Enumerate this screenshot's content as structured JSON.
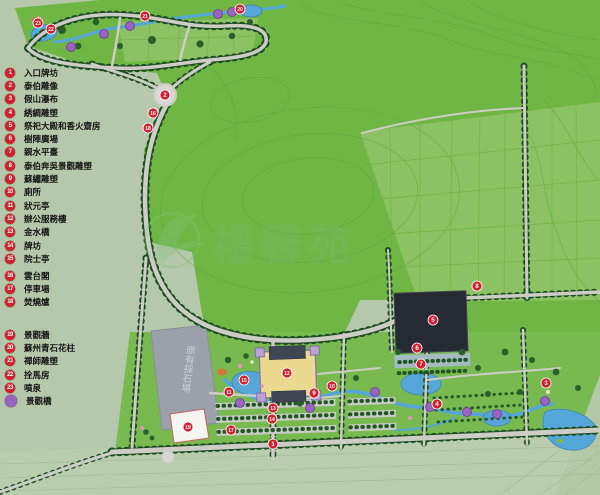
{
  "legend": {
    "groups": [
      {
        "items": [
          {
            "num": "1",
            "label": "入口牌坊"
          },
          {
            "num": "2",
            "label": "泰伯雕像"
          },
          {
            "num": "3",
            "label": "假山瀑布"
          },
          {
            "num": "4",
            "label": "綉綢雕塑"
          },
          {
            "num": "5",
            "label": "祭祀大殿和香火齋房"
          },
          {
            "num": "6",
            "label": "樹陣廣場"
          },
          {
            "num": "7",
            "label": "親水平臺"
          },
          {
            "num": "8",
            "label": "泰伯奔吳景觀雕塑"
          },
          {
            "num": "9",
            "label": "蘇繡雕塑"
          },
          {
            "num": "10",
            "label": "廁所"
          },
          {
            "num": "11",
            "label": "狀元亭"
          },
          {
            "num": "12",
            "label": "辦公服務樓"
          },
          {
            "num": "13",
            "label": "金水橋"
          },
          {
            "num": "14",
            "label": "牌坊"
          },
          {
            "num": "15",
            "label": "院士亭"
          }
        ]
      },
      {
        "items": [
          {
            "num": "16",
            "label": "雲台閣"
          },
          {
            "num": "17",
            "label": "停車場"
          },
          {
            "num": "18",
            "label": "焚燒爐"
          }
        ]
      },
      {
        "items": [
          {
            "num": "19",
            "label": "景觀牆"
          },
          {
            "num": "20",
            "label": "蘇州青石花柱"
          },
          {
            "num": "21",
            "label": "禪師雕塑"
          },
          {
            "num": "22",
            "label": "拴馬房"
          },
          {
            "num": "23",
            "label": "噴泉"
          }
        ]
      },
      {
        "items": [
          {
            "num": "",
            "label": "景觀橋",
            "type": "bridge"
          }
        ]
      }
    ]
  },
  "map": {
    "quarry_label": "原有採石場",
    "watermark_text": "楊馨苑",
    "colors": {
      "marker_red": "#d1202f",
      "bridge_purple": "#9b63c0",
      "water": "#55a7da",
      "hill_green": "#6fb645",
      "sage": "#b6c8ab",
      "road_grey": "#cdcdc6",
      "building_dark": "#262b33",
      "quarry_grey": "#9aa1ab",
      "courtyard_yellow": "#ead98f"
    },
    "markers": [
      {
        "n": "1",
        "x": 273,
        "y": 444
      },
      {
        "n": "2",
        "x": 165,
        "y": 95
      },
      {
        "n": "3",
        "x": 546,
        "y": 383
      },
      {
        "n": "4",
        "x": 437,
        "y": 404
      },
      {
        "n": "5",
        "x": 433,
        "y": 320
      },
      {
        "n": "6",
        "x": 417,
        "y": 348
      },
      {
        "n": "7",
        "x": 421,
        "y": 364
      },
      {
        "n": "8",
        "x": 477,
        "y": 286
      },
      {
        "n": "9",
        "x": 314,
        "y": 393
      },
      {
        "n": "10",
        "x": 332,
        "y": 386
      },
      {
        "n": "11",
        "x": 229,
        "y": 392
      },
      {
        "n": "12",
        "x": 287,
        "y": 373
      },
      {
        "n": "13",
        "x": 273,
        "y": 408
      },
      {
        "n": "14",
        "x": 272,
        "y": 419
      },
      {
        "n": "15",
        "x": 244,
        "y": 380
      },
      {
        "n": "16",
        "x": 153,
        "y": 113
      },
      {
        "n": "17",
        "x": 231,
        "y": 430
      },
      {
        "n": "18",
        "x": 148,
        "y": 128
      },
      {
        "n": "19",
        "x": 188,
        "y": 427
      },
      {
        "n": "20",
        "x": 240,
        "y": 9
      },
      {
        "n": "21",
        "x": 145,
        "y": 16
      },
      {
        "n": "22",
        "x": 51,
        "y": 29
      },
      {
        "n": "23",
        "x": 38,
        "y": 23
      }
    ],
    "bridges": [
      {
        "x": 71,
        "y": 47
      },
      {
        "x": 104,
        "y": 34
      },
      {
        "x": 130,
        "y": 26
      },
      {
        "x": 218,
        "y": 14
      },
      {
        "x": 232,
        "y": 12
      },
      {
        "x": 240,
        "y": 403
      },
      {
        "x": 310,
        "y": 408
      },
      {
        "x": 375,
        "y": 392
      },
      {
        "x": 430,
        "y": 407
      },
      {
        "x": 467,
        "y": 412
      },
      {
        "x": 497,
        "y": 414
      },
      {
        "x": 545,
        "y": 401
      }
    ]
  }
}
